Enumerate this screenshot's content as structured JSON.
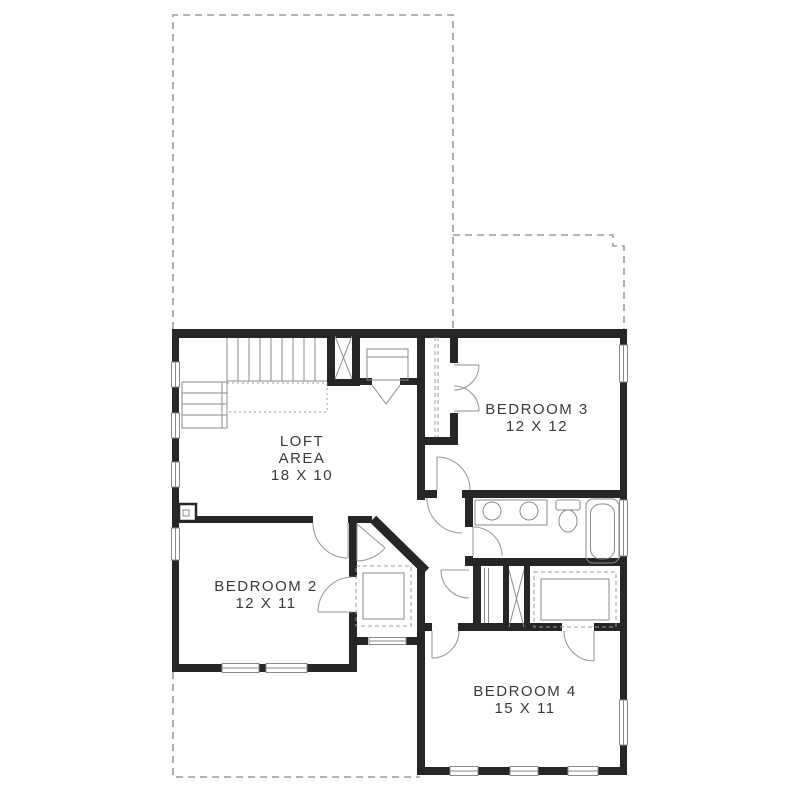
{
  "plan": {
    "rooms": [
      {
        "id": "loft",
        "lines": [
          "LOFT",
          "AREA",
          "18 X 10"
        ]
      },
      {
        "id": "bedroom-3",
        "lines": [
          "BEDROOM 3",
          "12 X 12"
        ]
      },
      {
        "id": "bedroom-2",
        "lines": [
          "BEDROOM 2",
          "12 X 11"
        ]
      },
      {
        "id": "bedroom-4",
        "lines": [
          "BEDROOM 4",
          "15 X 11"
        ]
      }
    ],
    "colors": {
      "background": "#ffffff",
      "wall": "#262626",
      "fixture_line": "#8a8a8a",
      "dashed_line": "#9b9b9b",
      "door_line": "#9a9a9a",
      "label_text": "#3a3a3a"
    },
    "symbols": [
      "staircase",
      "closet-x-brace",
      "linen-closet-x-brace",
      "wire-shelf-closet",
      "double-vanity-sinks",
      "toilet",
      "bathtub",
      "door-swing-arc",
      "window",
      "lower-level-dashed-outline",
      "fireplace-chase-box"
    ]
  }
}
